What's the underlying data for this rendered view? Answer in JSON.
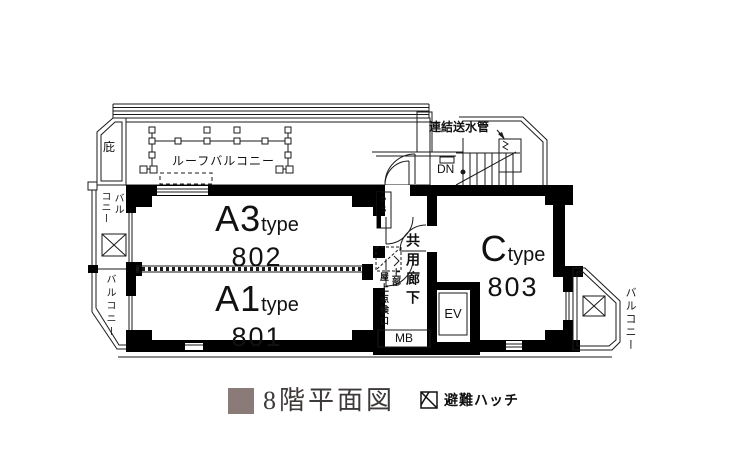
{
  "plan": {
    "rooms": [
      {
        "name": "A3",
        "suffix": "type",
        "number": "802"
      },
      {
        "name": "A1",
        "suffix": "type",
        "number": "801"
      },
      {
        "name": "C",
        "suffix": "type",
        "number": "803"
      }
    ],
    "labels": {
      "roof_balcony": "ルーフバルコニー",
      "eaves": "庇",
      "balcony_left_top_col_right": "バル",
      "balcony_left_top_col_left": "コニー",
      "balcony_left_bottom": "バルコニー",
      "balcony_right": "バルコニー",
      "standpipe": "連結送水管",
      "down": "DN",
      "corridor": "共用廊下",
      "roof_hatch_main": "屋上点検口",
      "roof_hatch_sub": "上部",
      "elevator": "EV",
      "meter_box": "MB",
      "pipe_shaft": "PS"
    }
  },
  "legend": {
    "floor_title": "8階平面図",
    "floor_color": "#8a7a78",
    "hatch_label": "避難ハッチ",
    "wall_color": "#000000",
    "line_color": "#1a1a1a"
  }
}
